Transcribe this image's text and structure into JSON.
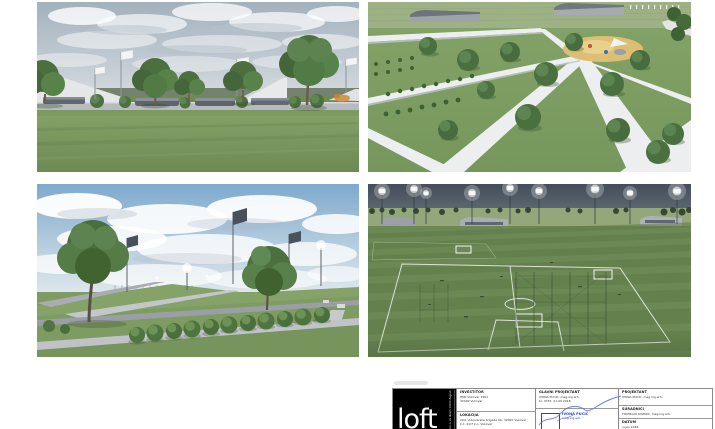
{
  "document": {
    "kind": "architectural presentation sheet",
    "renders": [
      {
        "name": "park-benches-view",
        "description": "Eye-level render of park with stone benches, round shrubs, trees and white banner light poles under a cloudy sky"
      },
      {
        "name": "park-aerial-view",
        "description": "Aerial render of park with diagonal white paths, planting rows, sand playground and sports buildings"
      },
      {
        "name": "park-promenade-view",
        "description": "Eye-level render of park promenade with large tree, row of round bushes, ramps and floodlight banners under blue cloudy sky"
      },
      {
        "name": "training-pitches-view",
        "description": "Dusk aerial render of football training pitches with glowing floodlights, goals, fencing cage and stands"
      }
    ]
  },
  "title_block": {
    "logo": {
      "text": "loft",
      "vertical_text": "loft d.o.o. za dizajn 10000 Zagreb"
    },
    "investor": {
      "label": "INVESTITOR",
      "line1": "HNK Vukovar 1991",
      "line2": "32000 Vukovar"
    },
    "location": {
      "label": "LOKACIJA",
      "line1": "204. Vukovarske brigade bb, 32000 Vukovar",
      "line2": "k.č. 41/7 k.o. Vukovar"
    },
    "chief_designer": {
      "label": "GLAVNI PROJEKTANT",
      "line1": "IVONA PUCIĆ, mag.ing.arh.",
      "line2": "br. 4767, 21.09.2018."
    },
    "designer": {
      "label": "PROJEKTANT",
      "line1": "IVONA PUCIĆ, mag.ing.arh."
    },
    "collaborators": {
      "label": "SURADNICI",
      "line1": "TOMISLAV KUZMIĆ, mag.ing.arh."
    },
    "date": {
      "label": "DATUM",
      "line1": "rujan 2018."
    },
    "stamp": {
      "line1": "IVONA PUCIĆ",
      "line2": "mag.ing.arh.",
      "color": "#2b3fd4"
    }
  },
  "colors": {
    "page_background": "#ffffff",
    "stamp_blue": "#2b3fd4",
    "logo_background": "#000000",
    "grass_green": "#7b985f",
    "path_gray": "#c6cacd",
    "sky_day_blue": "#7fa9ce",
    "sky_overcast": "#a3b1bd",
    "sky_dusk": "#4a535d"
  }
}
